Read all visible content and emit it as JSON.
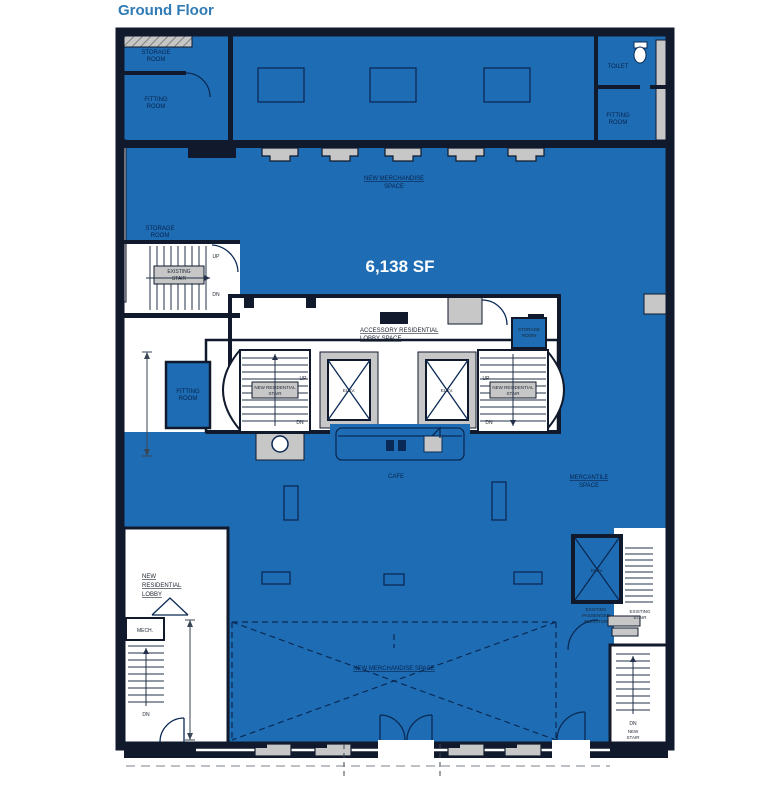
{
  "title": "Ground Floor",
  "area_label": "6,138 SF",
  "colors": {
    "plan_blue": "#1e6db4",
    "wall_dark": "#101a2c",
    "title_blue": "#2f7bb5",
    "label_navy": "#08234d",
    "poche_gray": "#c7c7c7",
    "area_text": "#ffffff"
  },
  "rooms": {
    "storage_top": [
      "STORAGE",
      "ROOM"
    ],
    "fitting_top_left": [
      "FITTING",
      "ROOM"
    ],
    "new_merch_top": [
      "NEW MERCHANDISE",
      "SPACE"
    ],
    "toilet": "TOILET",
    "fitting_top_right": [
      "FITTING",
      "ROOM"
    ],
    "storage_mid_left": [
      "STORAGE",
      "ROOM"
    ],
    "existing_stair_left": [
      "EXISTING",
      "STAIR"
    ],
    "accessory_lobby": [
      "ACCESSORY RESIDENTIAL",
      "LOBBY SPACE"
    ],
    "storage_corridor": [
      "STORAGE",
      "ROOM"
    ],
    "fitting_mid_left": [
      "FITTING",
      "ROOM"
    ],
    "res_stair_left": [
      "NEW RESIDENTIAL",
      "STAIR"
    ],
    "res_stair_right": [
      "NEW RESIDENTIAL",
      "STAIR"
    ],
    "elev1": "ELEV.",
    "elev2": "ELEV.",
    "elev3": "ELEV.",
    "cafe": "CAFE",
    "mercantile": [
      "MERCANTILE",
      "SPACE"
    ],
    "new_res_lobby": [
      "NEW",
      "RESIDENTIAL",
      "LOBBY"
    ],
    "mech": "MECH.",
    "exist_pass_elev": [
      "EXISTING",
      "PASSENGER",
      "ELEVATOR"
    ],
    "exist_stair_right": [
      "EXISTING",
      "STAIR"
    ],
    "new_merch_bottom": "NEW MERCHANDISE SPACE",
    "new_stair_bottom": [
      "NEW",
      "STAIR"
    ]
  },
  "directions": {
    "up": "UP",
    "dn": "DN"
  }
}
